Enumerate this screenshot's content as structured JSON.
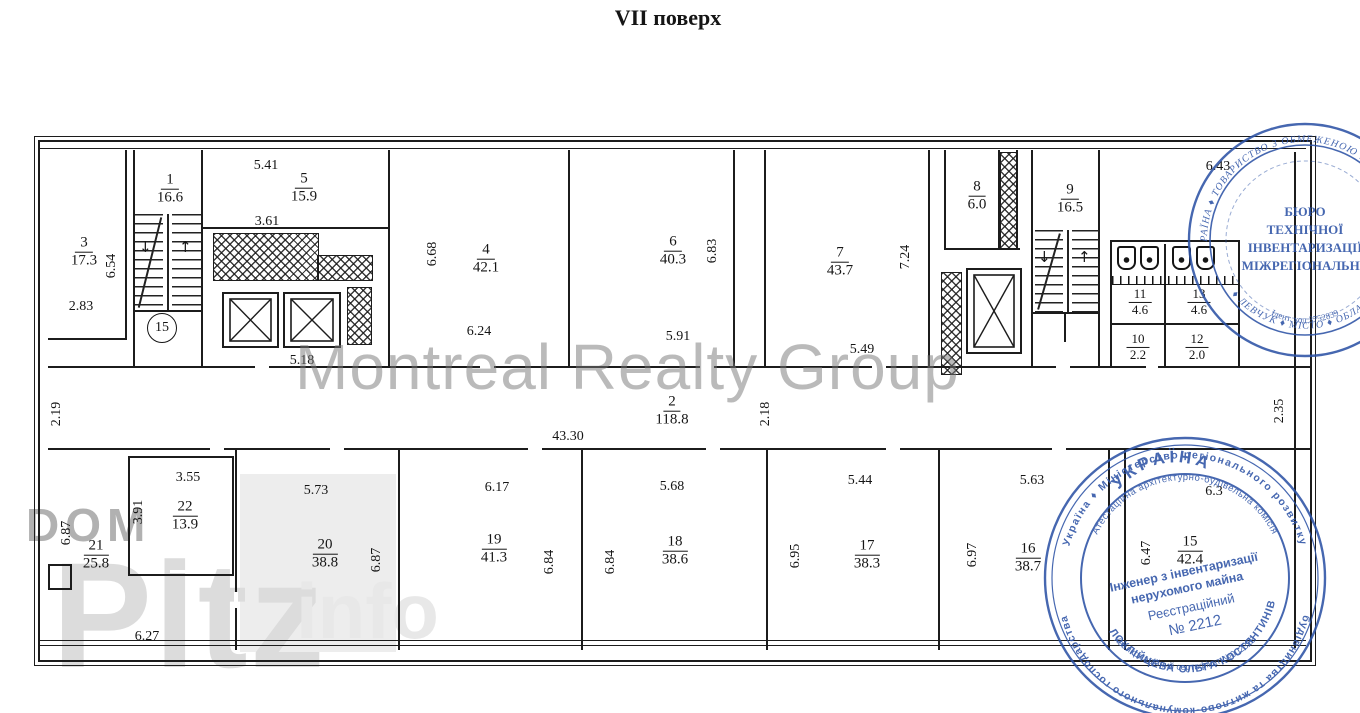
{
  "title": "VII поверх",
  "icons": {
    "arrow_down": "↓",
    "arrow_up": "↑"
  },
  "markers": {
    "stair_circle": "15"
  },
  "rooms": {
    "r1": {
      "num": "1",
      "area": "16.6"
    },
    "r2": {
      "num": "2",
      "area": "118.8"
    },
    "r3": {
      "num": "3",
      "area": "17.3"
    },
    "r4": {
      "num": "4",
      "area": "42.1"
    },
    "r5": {
      "num": "5",
      "area": "15.9"
    },
    "r6": {
      "num": "6",
      "area": "40.3"
    },
    "r7": {
      "num": "7",
      "area": "43.7"
    },
    "r8": {
      "num": "8",
      "area": "6.0"
    },
    "r9": {
      "num": "9",
      "area": "16.5"
    },
    "r10": {
      "num": "10",
      "area": "2.2"
    },
    "r11": {
      "num": "11",
      "area": "4.6"
    },
    "r12": {
      "num": "12",
      "area": "2.0"
    },
    "r13": {
      "num": "13",
      "area": "4.6"
    },
    "r15": {
      "num": "15",
      "area": "42.4"
    },
    "r16": {
      "num": "16",
      "area": "38.7"
    },
    "r17": {
      "num": "17",
      "area": "38.3"
    },
    "r18": {
      "num": "18",
      "area": "38.6"
    },
    "r19": {
      "num": "19",
      "area": "41.3"
    },
    "r20": {
      "num": "20",
      "area": "38.8"
    },
    "r21": {
      "num": "21",
      "area": "25.8"
    },
    "r22": {
      "num": "22",
      "area": "13.9"
    }
  },
  "dims": {
    "r3_h": "6.54",
    "r3_w": "2.83",
    "r5_w": "5.41",
    "r5_inner": "3.61",
    "r4_h": "6.68",
    "r4_w": "6.24",
    "r6_h": "6.83",
    "r6_w": "5.91",
    "r7_h": "7.24",
    "r7_w": "5.49",
    "lift_w": "5.18",
    "top_right": "6.43",
    "hall_left": "2.19",
    "hall_len": "43.30",
    "hall_mid": "2.18",
    "hall_right": "2.35",
    "r21_h": "6.87",
    "r21_w": "6.27",
    "r22_w": "3.55",
    "r22_h": "3.91",
    "r20_w": "5.73",
    "r20_h": "6.87",
    "r19_w": "6.17",
    "r19_h": "6.84",
    "r18_w": "5.68",
    "r18_h": "6.84",
    "r17_w": "5.44",
    "r17_h": "6.95",
    "r16_w": "5.63",
    "r16_h": "6.97",
    "r15_h": "6.47",
    "r15_w": "6.3"
  },
  "watermarks": {
    "center": "Montreal Realty Group",
    "corner_line1": "DOM",
    "corner_line2": "Pltz",
    "corner_line3": "info"
  },
  "stamps": {
    "color": "#2d53a6",
    "bti": {
      "ring_top": "УКРАЇНА ♦ ТОВАРИСТВО З ОБМЕЖЕНОЮ ВІДПОВІДАЛЬНІСТЮ",
      "ring_bottom": "♦ ЛЕВЧУК ♦ МІСТО ♦ ОБЛАСТЬ",
      "line1": "БЮРО",
      "line2": "ТЕХНІЧНОЇ",
      "line3": "ІНВЕНТАРИЗАЦІЇ",
      "line4": "МІЖРЕГІОНАЛЬНЕ",
      "ident": "Ідент. код 3752839",
      "number": "5"
    },
    "engineer": {
      "ring_top": "Україна ♦ Міністерство регіонального розвитку",
      "ring_bottom": "будівництва та житлово-комунального господарства",
      "ring_mid": "Атестаційна архітектурно-будівельна комісія",
      "cert": "Кваліфікаційний сертифікат №002318",
      "country": "УКРАЇНА",
      "line1": "Інженер з інвентаризації",
      "line2": "нерухомого майна",
      "line3": "Реєстраційний",
      "line4": "№ 2212",
      "name": "БІЛОКЛІЙЦЕВА ОЛЬГА КОСТЯНТИНІВНА"
    }
  }
}
